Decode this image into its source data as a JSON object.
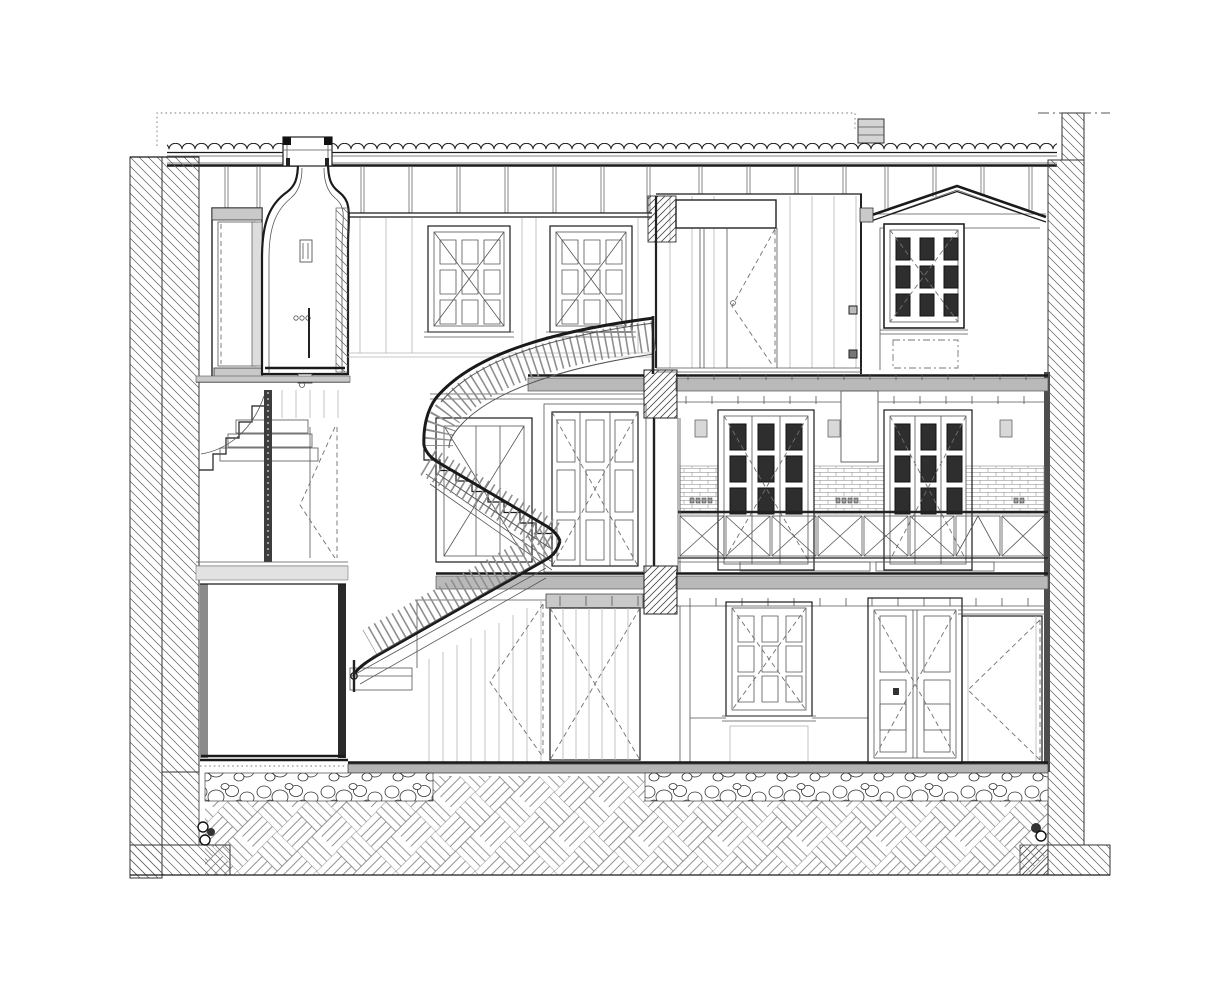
{
  "meta": {
    "title": "House cross-section drawing",
    "drawing_type": "architectural sectional elevation, black ink on white",
    "storeys": 3,
    "aria_label": "Black-and-white architectural cross-section of a three-storey house: barrel-tile roof with skylight, vaulted shower shaft, curved three-flight stair with turned balusters, first-floor gallery with X-braced railing and brick wainscot, dormer room, masonry side walls in diagonal hatch, rubble footing strip and basketweave-hatched ground"
  },
  "colors": {
    "paper": "#ffffff",
    "ink": "#1a1a1a",
    "ink-soft": "#555555",
    "hatch": "#5f5f5f",
    "slab-fill": "#b9b9b9",
    "panel-gray": "#c9c9c9",
    "glass-dark": "#2e2e2e",
    "dash-gray": "#707070",
    "baluster": "#8e8e8e"
  },
  "elements": {
    "roof": {
      "type": "barrel-tile band with rafter hangers",
      "skylight_curb": true,
      "roof_vent": true,
      "boundary_line": "dotted setback line above roof"
    },
    "walls": {
      "left": "double-leaf masonry, 45-degree hatch",
      "right": "masonry parapet wall, 45-degree hatch, stepped footing"
    },
    "levels": [
      {
        "level": "second floor",
        "features": [
          "twin 9-pane casement windows",
          "board partition with swing door",
          "dormer room with dark 9-pane window",
          "bell-vaulted shower shaft with skylight"
        ]
      },
      {
        "level": "first floor",
        "features": [
          "glazed door",
          "triple-panel double door",
          "open gallery",
          "french doors with dark panes",
          "brick wainscot",
          "X-braced guardrail",
          "wall sconces"
        ]
      },
      {
        "level": "ground floor",
        "features": [
          "water tank",
          "service stair",
          "boarded partition with swing door",
          "boarded X-door",
          "9-pane window",
          "tall double door",
          "sliding plank door"
        ]
      }
    ],
    "stair": {
      "form": "three-flight winding stair",
      "balustrade": "closely spaced turned balusters with dark handrail"
    },
    "ground": {
      "footing_strip": "rubble stones",
      "soil_hatch": "45-degree basketweave",
      "drains": 2
    }
  }
}
